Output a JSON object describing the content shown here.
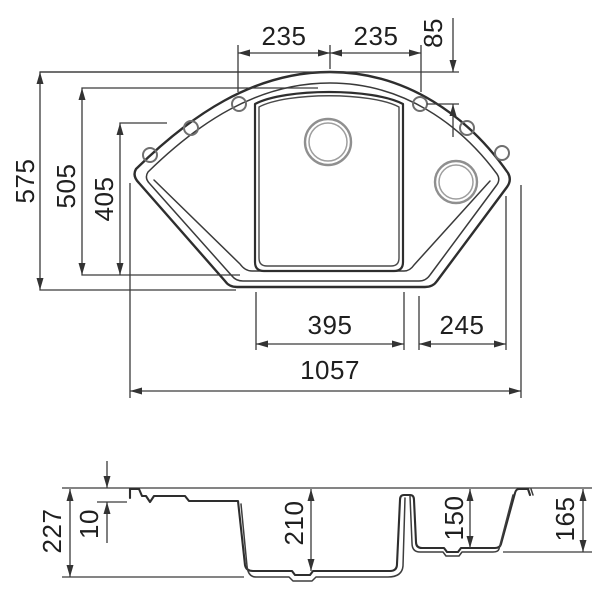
{
  "dimensions": {
    "plan": {
      "left_hole_span": "235",
      "right_hole_span": "235",
      "hole_offset": "85",
      "overall_depth": "575",
      "inner_depth": "505",
      "wing_depth": "405",
      "main_bowl_width": "395",
      "corner_bowl_width": "245",
      "overall_width": "1057"
    },
    "section": {
      "total_height": "227",
      "rim_height": "10",
      "main_bowl_depth": "210",
      "half_bowl_depth": "150",
      "edge_height": "165"
    }
  }
}
